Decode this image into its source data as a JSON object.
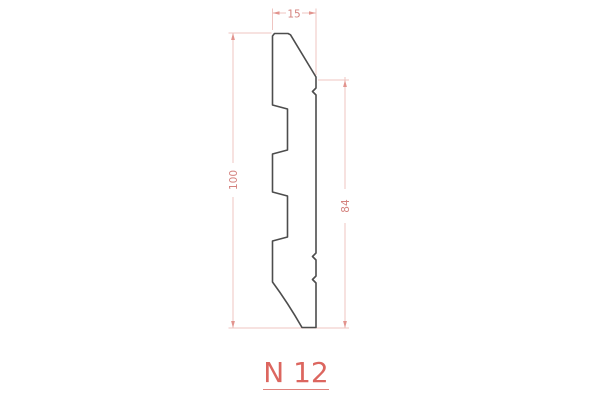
{
  "drawing": {
    "label": "N 12",
    "dimensions": {
      "top_width": "15",
      "total_height": "100",
      "face_height": "84"
    },
    "colors": {
      "background": "#ffffff",
      "profile_line": "#4d4d4d",
      "dimension_line": "#efc5c1",
      "dimension_arrow": "#e2948e",
      "dimension_text": "#d4827e",
      "label_text": "#dc665f"
    }
  }
}
